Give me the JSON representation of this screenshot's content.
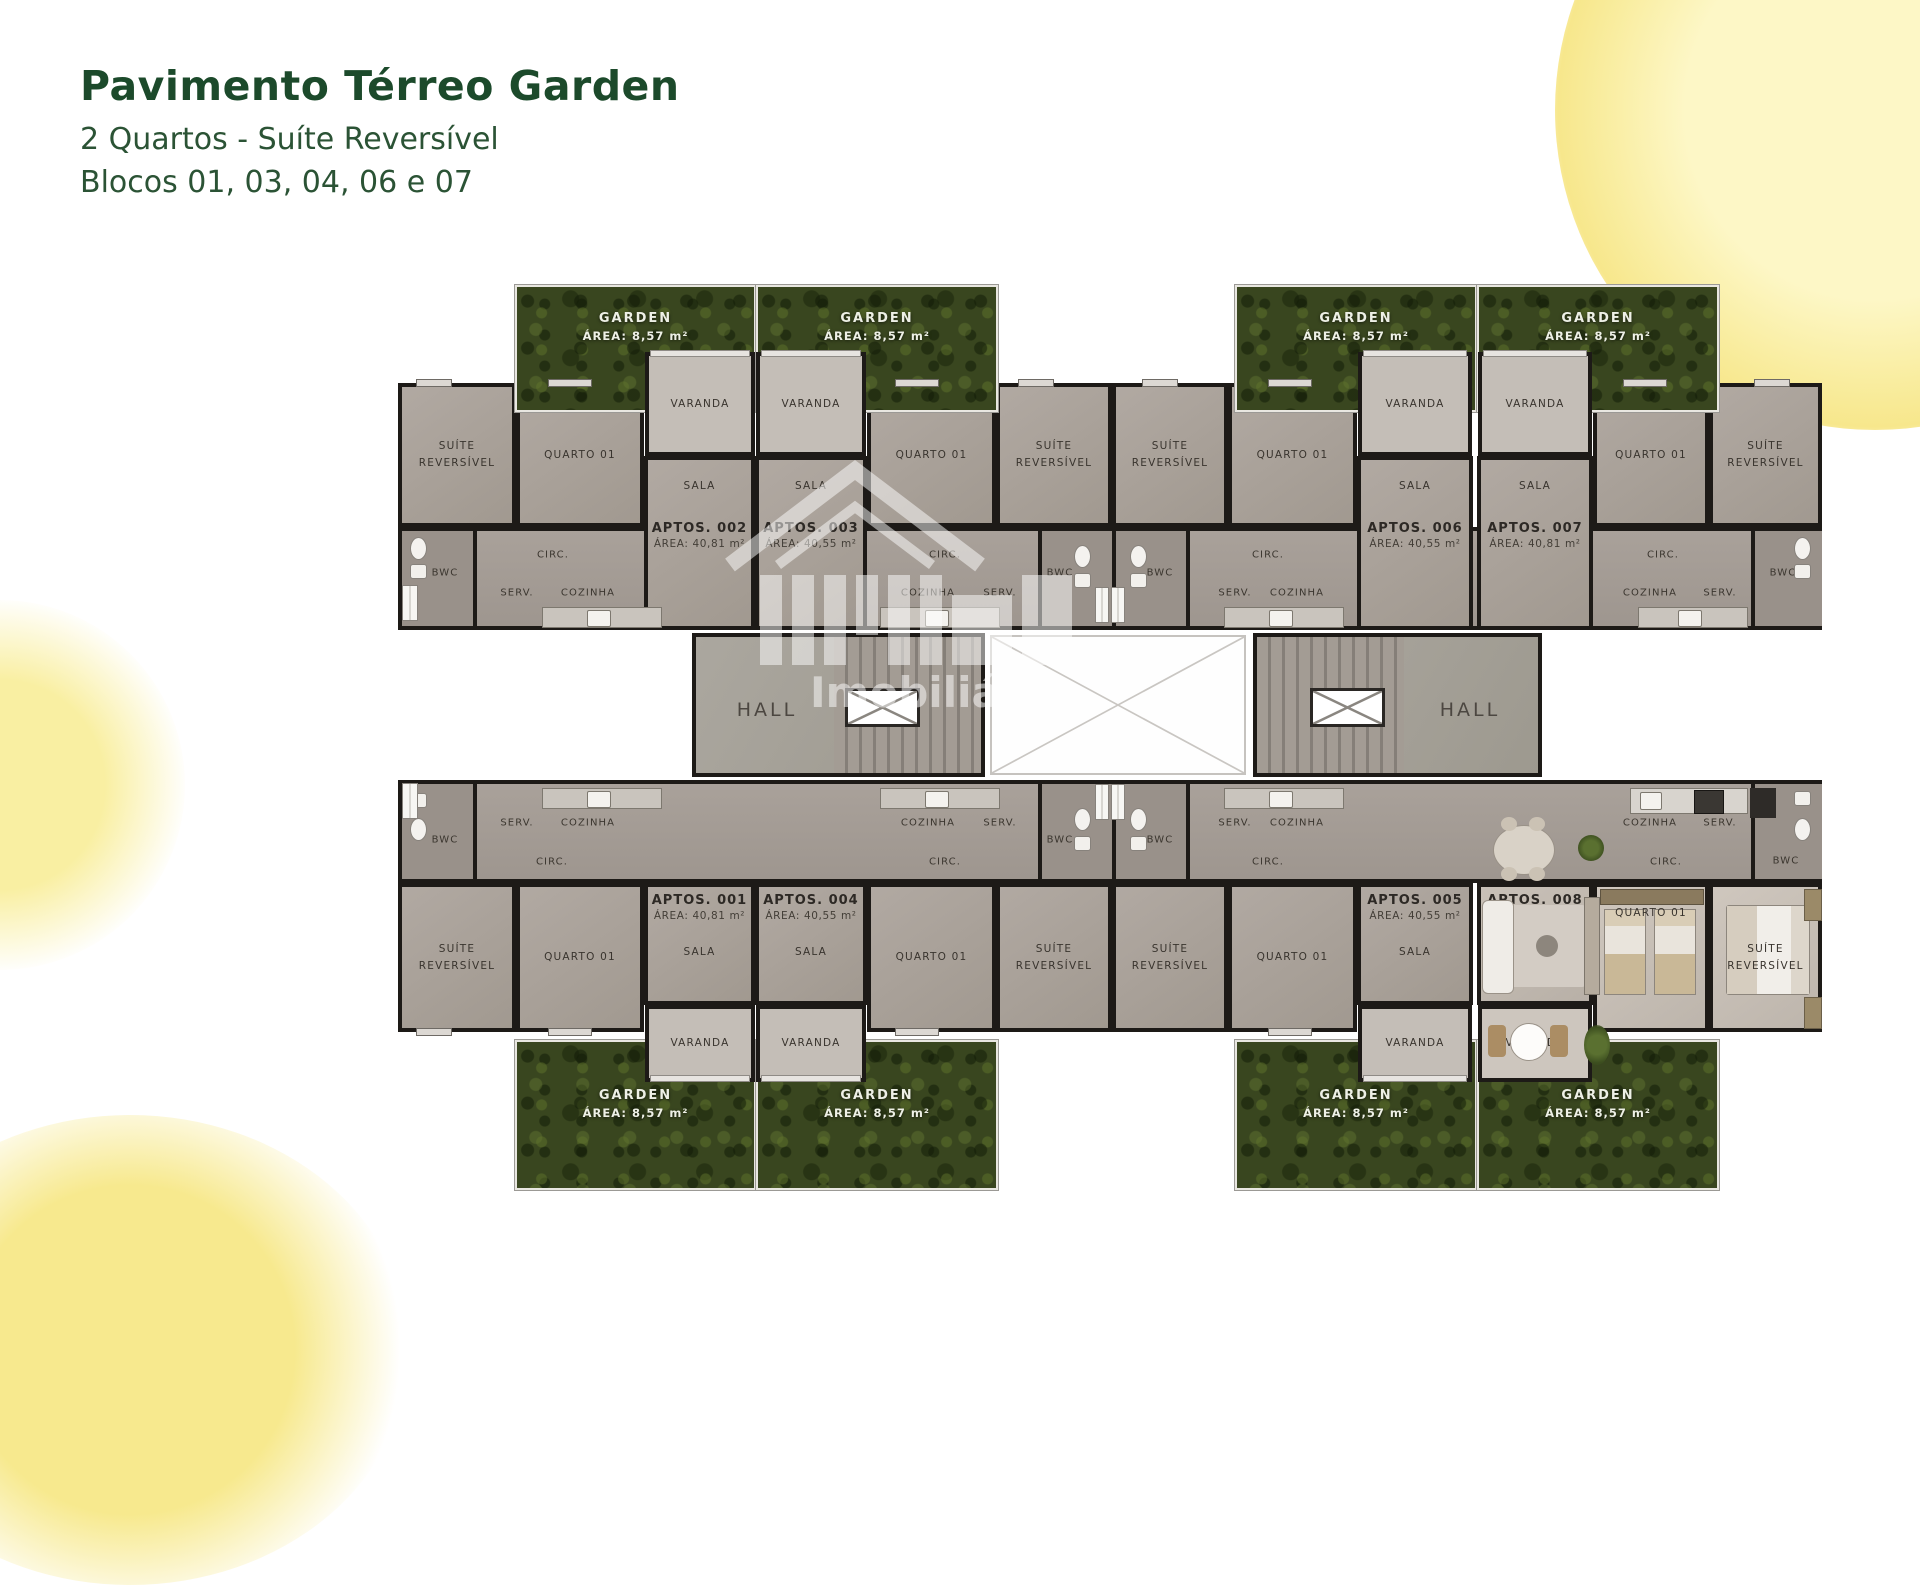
{
  "title": {
    "heading": "Pavimento Térreo Garden",
    "subtitle": "2 Quartos - Suíte Reversível",
    "blocks": "Blocos 01, 03, 04, 06 e 07"
  },
  "watermark": {
    "brand": "Imobiliária"
  },
  "rooms": {
    "suite": "SUÍTE REVERSÍVEL",
    "quarto": "QUARTO 01",
    "sala": "SALA",
    "varanda": "VARANDA",
    "cozinha": "COZINHA",
    "serv": "SERV.",
    "circ": "CIRC.",
    "bwc": "BWC",
    "hall": "HALL",
    "garden": "GARDEN",
    "garden_area": "ÁREA: 8,57 m²"
  },
  "apartments": [
    {
      "name": "APTOS. 001",
      "area": "ÁREA: 40,81 m²"
    },
    {
      "name": "APTOS. 002",
      "area": "ÁREA: 40,81 m²"
    },
    {
      "name": "APTOS. 003",
      "area": "ÁREA: 40,55 m²"
    },
    {
      "name": "APTOS. 004",
      "area": "ÁREA: 40,55 m²"
    },
    {
      "name": "APTOS. 005",
      "area": "ÁREA: 40,55 m²"
    },
    {
      "name": "APTOS. 006",
      "area": "ÁREA: 40,55 m²"
    },
    {
      "name": "APTOS. 007",
      "area": "ÁREA: 40,81 m²"
    },
    {
      "name": "APTOS. 008",
      "area": "ÁREA: 40,81 m²"
    }
  ],
  "colors": {
    "accent_green": "#1c4a2b",
    "garden_green": "#39461f",
    "wall": "#1d1a17",
    "room_fill": "#a9a19a",
    "highlight_yellow": "#f8e98f"
  }
}
